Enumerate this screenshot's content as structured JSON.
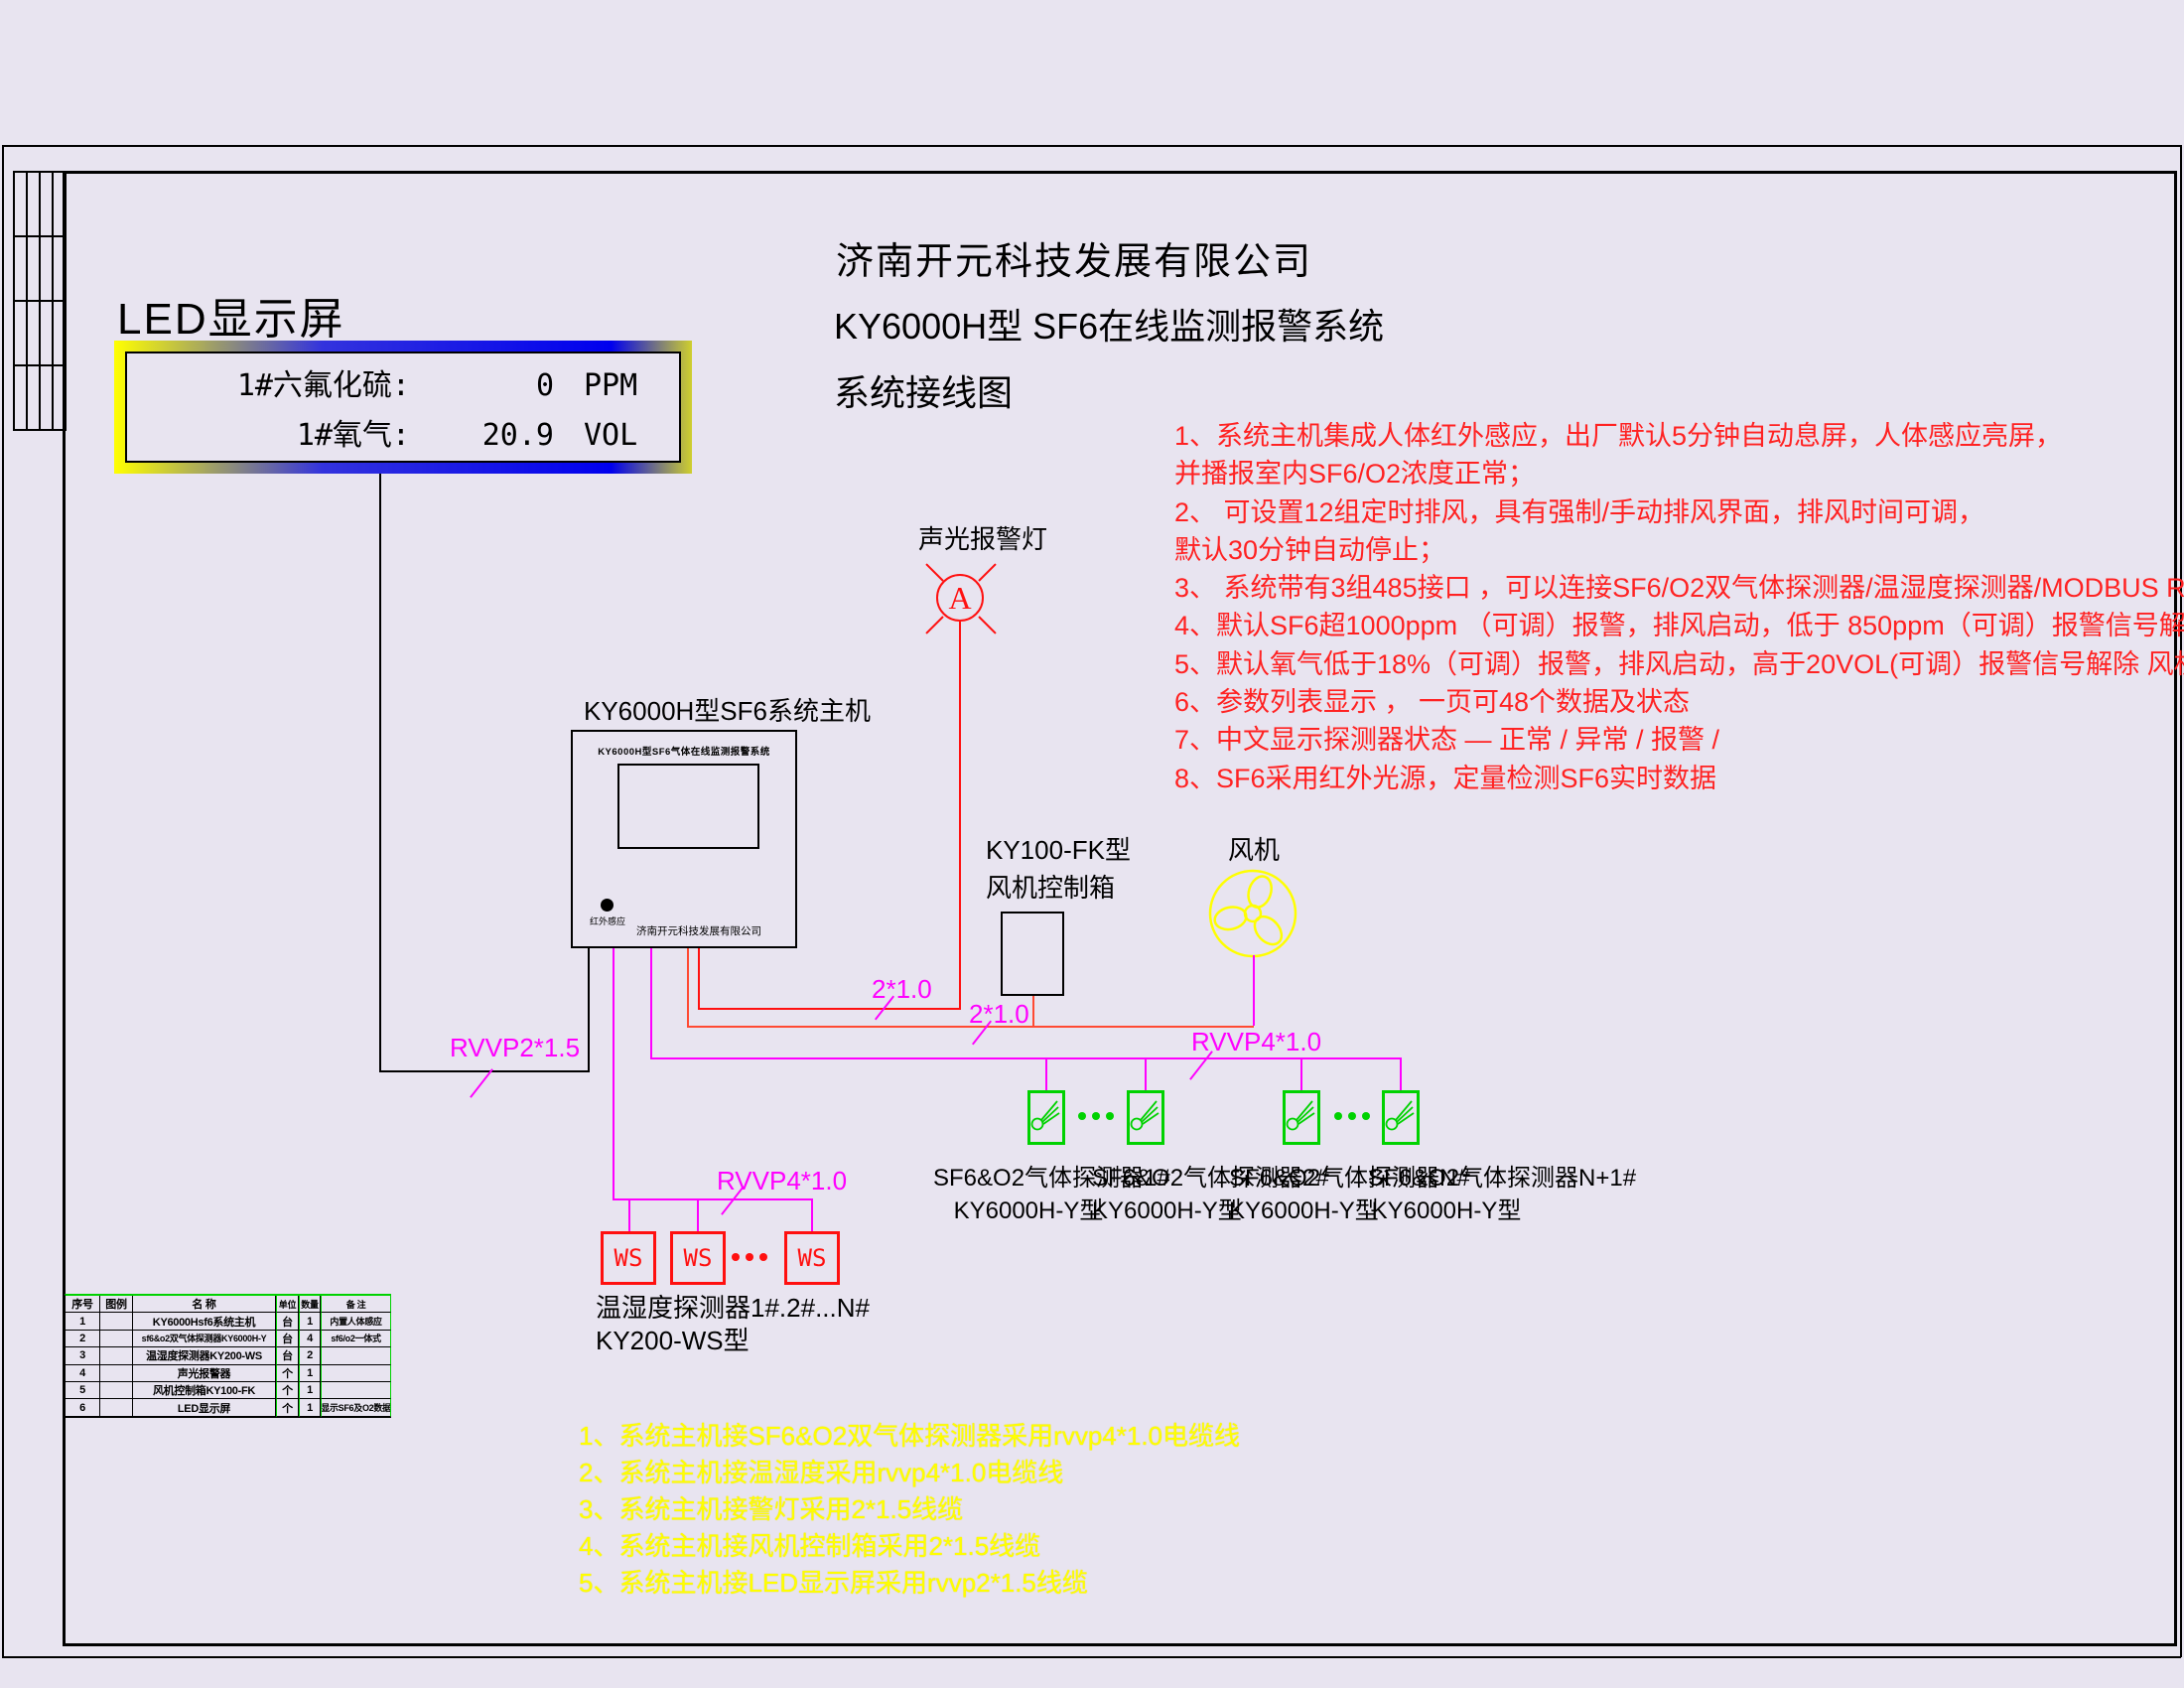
{
  "colors": {
    "background": "#e8e4f0",
    "wire_red": "#ff1010",
    "wire_magenta": "#ff00ff",
    "detector_green": "#00d200",
    "note_red": "#ff2222",
    "note_yellow": "#ffff00",
    "led_border_blue": "#0000ee",
    "led_border_yellow": "#ffff00"
  },
  "led": {
    "title": "LED显示屏",
    "rows": [
      {
        "name": "1#六氟化硫:",
        "value": "0",
        "unit": "PPM"
      },
      {
        "name": "1#氧气:",
        "value": "20.9",
        "unit": "VOL"
      }
    ]
  },
  "header": {
    "company": "济南开元科技发展有限公司",
    "system": "KY6000H型 SF6在线监测报警系统",
    "drawing": "系统接线图"
  },
  "red_notes": [
    "1、系统主机集成人体红外感应，出厂默认5分钟自动息屏，人体感应亮屏，",
    "并播报室内SF6/O2浓度正常；",
    "2、 可设置12组定时排风，具有强制/手动排风界面，排风时间可调，",
    "默认30分钟自动停止；",
    "3、 系统带有3组485接口 ，可以连接SF6/O2双气体探测器/温湿度探测器/MODBUS RTU上传；",
    "4、默认SF6超1000ppm （可调）报警，排风启动，低于 850ppm（可调）报警信号解除，风机延时停止",
    "5、默认氧气低于18%（可调）报警，排风启动，高于20VOL(可调）报警信号解除 风机延时停止",
    "6、参数列表显示 ， 一页可48个数据及状态",
    "7、中文显示探测器状态  —   正常  /   异常  /   报警      /",
    "8、SF6采用红外光源，定量检测SF6实时数据"
  ],
  "main_unit": {
    "caption": "KY6000H型SF6系统主机",
    "panel_title": "KY6000H型SF6气体在线监测报警系统",
    "ir_dot_label": "红外感应",
    "brand": "济南开元科技发展有限公司"
  },
  "alarm_lamp": {
    "caption": "声光报警灯",
    "symbol": "A"
  },
  "fan_control_box": {
    "caption_line1": "KY100-FK型",
    "caption_line2": "风机控制箱"
  },
  "fan": {
    "caption": "风机"
  },
  "cable_labels": {
    "led_cable": "RVVP2*1.5",
    "lamp_cable": "2*1.0",
    "fan_box_cable": "2*1.0",
    "gas_detector_bus": "RVVP4*1.0",
    "ws_detector_bus": "RVVP4*1.0"
  },
  "gas_detectors": {
    "items": [
      {
        "line1": "SF6&O2气体探测器1#",
        "line2": "KY6000H-Y型"
      },
      {
        "line1": "SF6&O2气体探测器2#",
        "line2": "KY6000H-Y型"
      },
      {
        "line1": "SF6&O2气体探测器N#",
        "line2": "KY6000H-Y型"
      },
      {
        "line1": "SF6&O2气体探测器N+1#",
        "line2": "KY6000H-Y型"
      }
    ]
  },
  "ws_detectors": {
    "box_label": "WS",
    "caption_line1": "温湿度探测器1#.2#...N#",
    "caption_line2": "KY200-WS型"
  },
  "bom_table": {
    "headers": [
      "序号",
      "图例",
      "名  称",
      "单位",
      "数量",
      "备 注"
    ],
    "rows": [
      [
        "1",
        "",
        "KY6000Hsf6系统主机",
        "台",
        "1",
        "内置人体感应"
      ],
      [
        "2",
        "",
        "sf6&o2双气体探测器KY6000H-Y",
        "台",
        "4",
        "sf6/o2一体式"
      ],
      [
        "3",
        "",
        "温湿度探测器KY200-WS",
        "台",
        "2",
        ""
      ],
      [
        "4",
        "",
        "声光报警器",
        "个",
        "1",
        ""
      ],
      [
        "5",
        "",
        "风机控制箱KY100-FK",
        "个",
        "1",
        ""
      ],
      [
        "6",
        "",
        "LED显示屏",
        "个",
        "1",
        "显示SF6及O2数据"
      ]
    ]
  },
  "yellow_notes": [
    "1、系统主机接SF6&O2双气体探测器采用rvvp4*1.0电缆线",
    "2、系统主机接温湿度采用rvvp4*1.0电缆线",
    "3、系统主机接警灯采用2*1.5线缆",
    "4、系统主机接风机控制箱采用2*1.5线缆",
    "5、系统主机接LED显示屏采用rvvp2*1.5线缆"
  ]
}
